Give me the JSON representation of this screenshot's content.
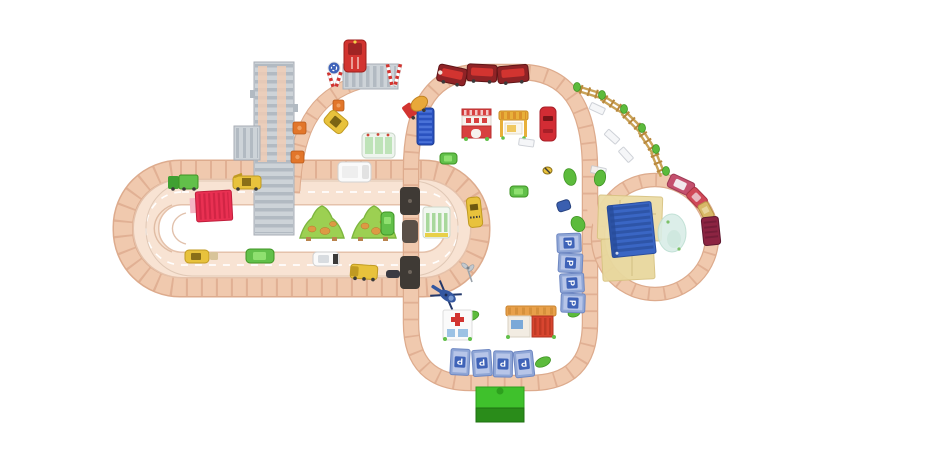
{
  "scene": {
    "type": "overhead product photo of a wooden toy train and road play set",
    "background": "#ffffff",
    "labels": {
      "parking": "P"
    },
    "colors": {
      "track_wood": "#f0c9ae",
      "road": "#f8e3d3",
      "container_red": "#e93052",
      "warehouse_blue": "#3a66c4",
      "tunnel_green": "#3fc12c",
      "tunnel_green_dark": "#2a8c1a",
      "parking_blue": "#3f63b8",
      "train_dark_red": "#8f2326",
      "train_bright_red": "#d23430",
      "grass_green": "#9cd052",
      "vehicle_green": "#62c04a",
      "vehicle_yellow": "#e8c23c",
      "gray_structure": "#cdd3d8",
      "pink_train": "#c4506e",
      "maroon_wagon": "#8c2442",
      "helicopter_blue": "#3457a0",
      "fence_tan": "#c9a257",
      "pond_blue": "#d9ede7",
      "mat_yellow": "#ecdca6"
    },
    "objects": [
      "left road-and-rail oval with two lanes",
      "tall center rail loop",
      "right circular rail loop",
      "gray elevated bridge ramp",
      "gray level crossing with striped signs",
      "red steam train with three cars",
      "pink passenger train on circle",
      "maroon freight wagon",
      "red fire truck",
      "cement mixer truck",
      "red shipping container",
      "blue container",
      "fire station building",
      "market stall",
      "red car",
      "white van",
      "white car",
      "yellow taxi",
      "yellow digger",
      "yellow cars",
      "green truck",
      "green cars",
      "blue car",
      "helicopter",
      "hospital with red cross",
      "garage with orange roof",
      "blue warehouse on yellow mat",
      "pond",
      "two trees with animals",
      "curved fence with green posts",
      "eight blue parking P tiles",
      "green tunnel",
      "bus shelters",
      "orange track markers",
      "gray windmill signal",
      "white park benches"
    ]
  }
}
